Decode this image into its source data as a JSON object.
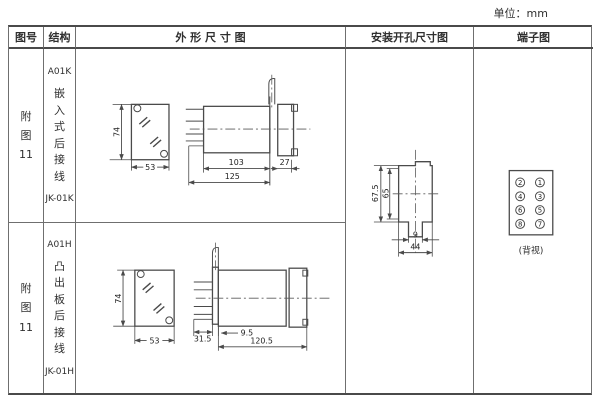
{
  "unit_label": "单位：mm",
  "header": {
    "fig_no": "图号",
    "structure": "结构",
    "outline": "外 形 尺 寸 图",
    "install": "安装开孔尺寸图",
    "terminal": "端子图"
  },
  "rows": [
    {
      "fig_no": "附\n图\n11",
      "model": "A01K",
      "mount_desc": "嵌\n入\n式\n后\n接\n线",
      "code": "JK-01K",
      "dims": {
        "front_height": "74",
        "front_width": "53",
        "body_length": "103",
        "flange_depth": "27",
        "total_length": "125"
      }
    },
    {
      "fig_no": "附\n图\n11",
      "model": "A01H",
      "mount_desc": "凸\n出\n板\n后\n接\n线",
      "code": "JK-01H",
      "dims": {
        "front_height": "74",
        "front_width": "53",
        "plate_offset": "31.5",
        "inset": "9.5",
        "total_length": "120.5"
      }
    }
  ],
  "install_dims": {
    "outer_height": "67.5",
    "inner_height": "65",
    "slot_width": "9",
    "opening_width": "44"
  },
  "terminal_diagram": {
    "left_column": [
      "2",
      "4",
      "6",
      "8"
    ],
    "right_column": [
      "1",
      "3",
      "5",
      "7"
    ],
    "caption": "(背视)"
  }
}
